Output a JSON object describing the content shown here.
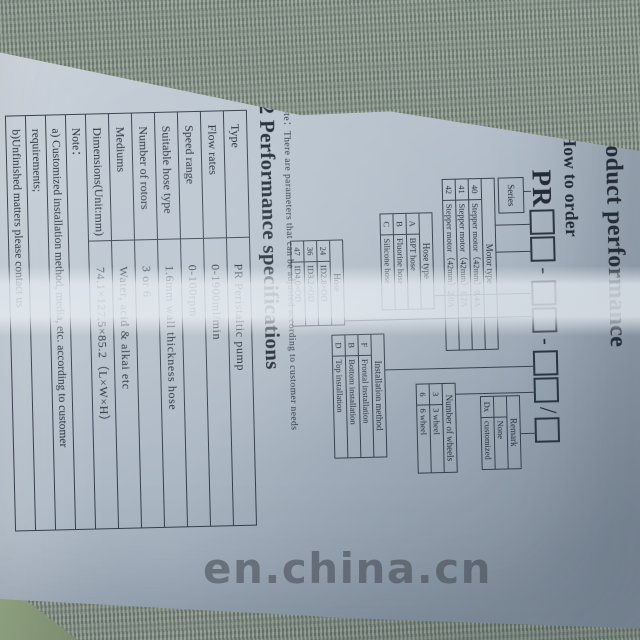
{
  "photo": {
    "watermark_text": "en.china.cn"
  },
  "page": {
    "section_title": "2 Product performance",
    "subsection_title": "2.1 How to order",
    "code": {
      "prefix": "PR",
      "hyphen": "-",
      "slash": "/"
    },
    "diagram": {
      "series_label": "Series",
      "motor_type": {
        "header": "Motor type",
        "rows": [
          [
            "40",
            "Stepper motor（42mm）0.4A"
          ],
          [
            "41",
            "Stepper motor（42mm）1.2A"
          ],
          [
            "42",
            "Stepper motor（42mm）2.0A"
          ]
        ]
      },
      "hose_type": {
        "header": "Hose type",
        "rows": [
          [
            "A",
            "BPT hose"
          ],
          [
            "B",
            "Fluorine hose"
          ],
          [
            "C",
            "Silicone hose"
          ]
        ]
      },
      "hose": {
        "header": "Hose",
        "rows": [
          [
            "24",
            "ID2.8×OD"
          ],
          [
            "36",
            "ID3.2×OD"
          ],
          [
            "47",
            "ID4.0×OD"
          ]
        ]
      },
      "installation": {
        "header": "Installation method",
        "rows": [
          [
            "F",
            "Frontal installation"
          ],
          [
            "B",
            "Bottom installation"
          ],
          [
            "D",
            "Top installation"
          ]
        ]
      },
      "wheels": {
        "header": "Number of wheels",
        "rows": [
          [
            "3",
            "3 wheel"
          ],
          [
            "6",
            "6 wheel"
          ]
        ]
      },
      "remark": {
        "header": "Remark",
        "rows": [
          [
            "",
            "None"
          ],
          [
            "Dx",
            "customized"
          ]
        ]
      },
      "note": "Note：There are parameters that can be adjusted according to customer needs"
    },
    "spec": {
      "title": "2.2 Performance specifications",
      "rows": [
        [
          "Type",
          "PR Peristaltic pump"
        ],
        [
          "Flow rates",
          "0-1900ml/min"
        ],
        [
          "Speed range",
          "0-100rpm"
        ],
        [
          "Suitable hose type",
          "1.6mm wall thickness hose"
        ],
        [
          "Number of rotors",
          "3 or 6"
        ],
        [
          "Mediums",
          "Water, acid & alkai etc"
        ],
        [
          "Dimensions(Unit:mm)",
          "74.1×127.5×85.2（L×W×H）"
        ]
      ],
      "notes": [
        [
          "Note："
        ],
        [
          "a) Customized installation method, media, etc. according to customer"
        ],
        [
          "requirements;"
        ],
        [
          "b)Unfinished matters please contact us"
        ]
      ]
    }
  }
}
